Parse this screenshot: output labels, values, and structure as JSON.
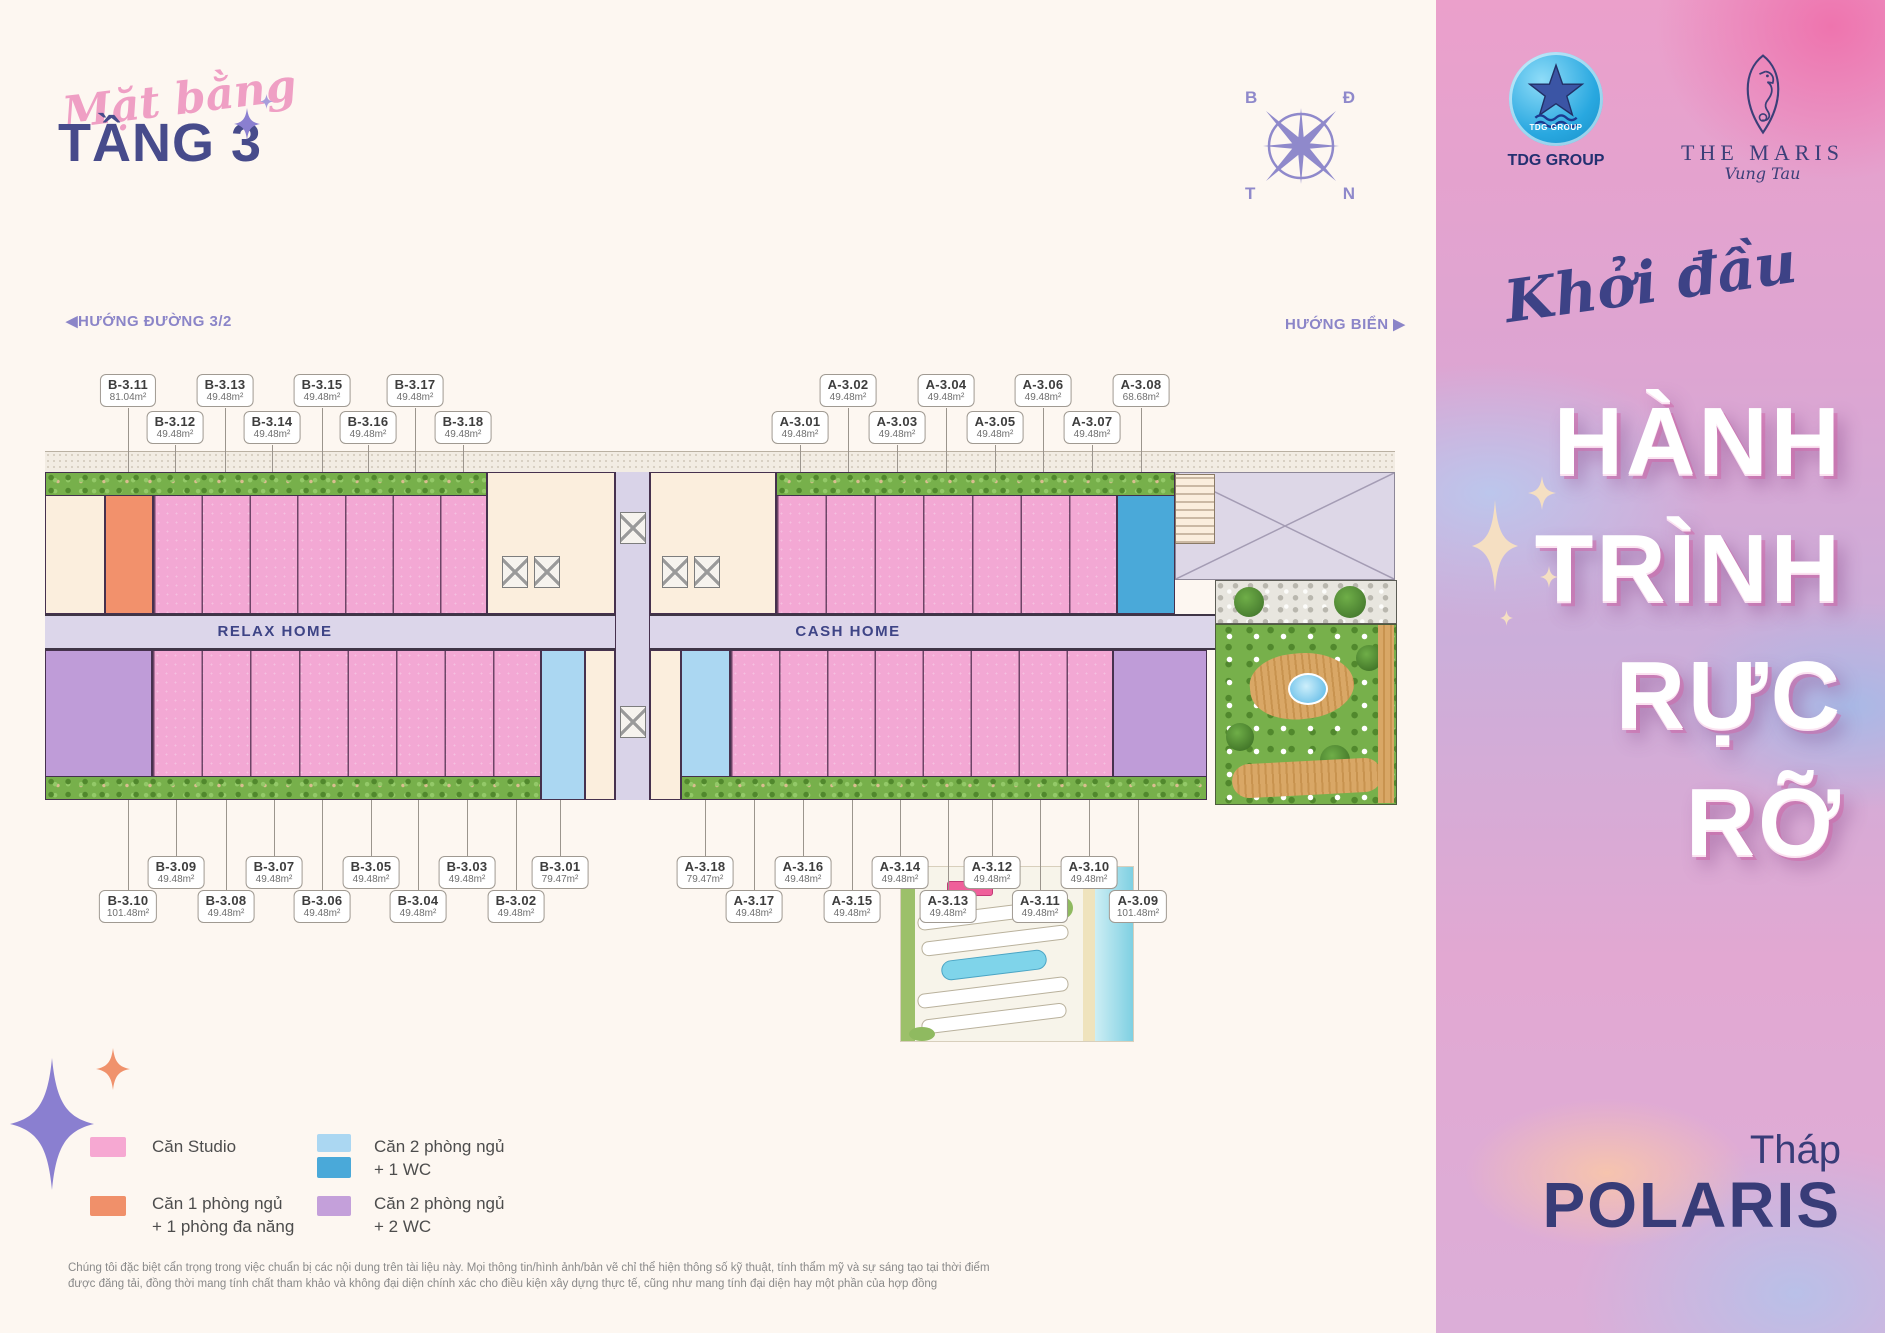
{
  "header": {
    "script_title": "Mặt bằng",
    "floor_title": "TẦNG 3"
  },
  "compass": {
    "nw": "B",
    "ne": "Đ",
    "sw": "T",
    "se": "N"
  },
  "logos": {
    "tdg": {
      "badge": "TDG GROUP",
      "caption": "TDG GROUP"
    },
    "maris": {
      "name": "THE MARIS",
      "city": "Vung Tau"
    }
  },
  "directions": {
    "road_arrow": "◀",
    "road_label": "HƯỚNG ĐƯỜNG 3/2",
    "sea_label": "HƯỚNG BIỂN",
    "sea_arrow": "▶"
  },
  "plan": {
    "corridor_left": "RELAX HOME",
    "corridor_right": "CASH HOME",
    "top_units": [
      {
        "id": "B-3.11",
        "area": "81.04m²",
        "row": 1,
        "x": 128
      },
      {
        "id": "B-3.12",
        "area": "49.48m²",
        "row": 2,
        "x": 175
      },
      {
        "id": "B-3.13",
        "area": "49.48m²",
        "row": 1,
        "x": 225
      },
      {
        "id": "B-3.14",
        "area": "49.48m²",
        "row": 2,
        "x": 272
      },
      {
        "id": "B-3.15",
        "area": "49.48m²",
        "row": 1,
        "x": 322
      },
      {
        "id": "B-3.16",
        "area": "49.48m²",
        "row": 2,
        "x": 368
      },
      {
        "id": "B-3.17",
        "area": "49.48m²",
        "row": 1,
        "x": 415
      },
      {
        "id": "B-3.18",
        "area": "49.48m²",
        "row": 2,
        "x": 463
      },
      {
        "id": "A-3.01",
        "area": "49.48m²",
        "row": 2,
        "x": 800
      },
      {
        "id": "A-3.02",
        "area": "49.48m²",
        "row": 1,
        "x": 848
      },
      {
        "id": "A-3.03",
        "area": "49.48m²",
        "row": 2,
        "x": 897
      },
      {
        "id": "A-3.04",
        "area": "49.48m²",
        "row": 1,
        "x": 946
      },
      {
        "id": "A-3.05",
        "area": "49.48m²",
        "row": 2,
        "x": 995
      },
      {
        "id": "A-3.06",
        "area": "49.48m²",
        "row": 1,
        "x": 1043
      },
      {
        "id": "A-3.07",
        "area": "49.48m²",
        "row": 2,
        "x": 1092
      },
      {
        "id": "A-3.08",
        "area": "68.68m²",
        "row": 1,
        "x": 1141
      }
    ],
    "bottom_units": [
      {
        "id": "B-3.10",
        "area": "101.48m²",
        "row": 2,
        "x": 128
      },
      {
        "id": "B-3.09",
        "area": "49.48m²",
        "row": 1,
        "x": 176
      },
      {
        "id": "B-3.08",
        "area": "49.48m²",
        "row": 2,
        "x": 226
      },
      {
        "id": "B-3.07",
        "area": "49.48m²",
        "row": 1,
        "x": 274
      },
      {
        "id": "B-3.06",
        "area": "49.48m²",
        "row": 2,
        "x": 322
      },
      {
        "id": "B-3.05",
        "area": "49.48m²",
        "row": 1,
        "x": 371
      },
      {
        "id": "B-3.04",
        "area": "49.48m²",
        "row": 2,
        "x": 418
      },
      {
        "id": "B-3.03",
        "area": "49.48m²",
        "row": 1,
        "x": 467
      },
      {
        "id": "B-3.02",
        "area": "49.48m²",
        "row": 2,
        "x": 516
      },
      {
        "id": "B-3.01",
        "area": "79.47m²",
        "row": 1,
        "x": 560
      },
      {
        "id": "A-3.18",
        "area": "79.47m²",
        "row": 1,
        "x": 705
      },
      {
        "id": "A-3.17",
        "area": "49.48m²",
        "row": 2,
        "x": 754
      },
      {
        "id": "A-3.16",
        "area": "49.48m²",
        "row": 1,
        "x": 803
      },
      {
        "id": "A-3.15",
        "area": "49.48m²",
        "row": 2,
        "x": 852
      },
      {
        "id": "A-3.14",
        "area": "49.48m²",
        "row": 1,
        "x": 900
      },
      {
        "id": "A-3.13",
        "area": "49.48m²",
        "row": 2,
        "x": 948
      },
      {
        "id": "A-3.12",
        "area": "49.48m²",
        "row": 1,
        "x": 992
      },
      {
        "id": "A-3.11",
        "area": "49.48m²",
        "row": 2,
        "x": 1040
      },
      {
        "id": "A-3.10",
        "area": "49.48m²",
        "row": 1,
        "x": 1089
      },
      {
        "id": "A-3.09",
        "area": "101.48m²",
        "row": 2,
        "x": 1138
      }
    ]
  },
  "legend": {
    "items": [
      {
        "label1": "Căn Studio",
        "label2": "",
        "colors": [
          "#f6a8d2"
        ]
      },
      {
        "label1": "Căn 1 phòng ngủ",
        "label2": "+ 1 phòng đa năng",
        "colors": [
          "#f0906a"
        ]
      },
      {
        "label1": "Căn 2 phòng ngủ",
        "label2": "+ 1 WC",
        "colors": [
          "#abd7f2",
          "#4aa9d9"
        ]
      },
      {
        "label1": "Căn 2 phòng ngủ",
        "label2": "+ 2 WC",
        "colors": [
          "#c4a0da"
        ]
      }
    ]
  },
  "sidebar": {
    "tagline": "Khởi đầu",
    "headline": [
      "HÀNH",
      "TRÌNH",
      "RỰC RỠ"
    ],
    "tower_label": "Tháp",
    "tower_name": "POLARIS"
  },
  "disclaimer": {
    "line1": "Chúng tôi đặc biệt cẩn trọng trong việc chuẩn bị các nội dung trên tài liệu này. Mọi thông tin/hình ảnh/bản vẽ chỉ thể hiện thông số kỹ thuật, tính thẩm mỹ và sự sáng tạo tại thời điểm",
    "line2": "được đăng tải, đồng thời mang tính chất tham khảo và không đại diện chính xác cho điều kiện xây dựng thực tế, cũng như mang tính đại diện hay một phần của hợp đồng"
  }
}
